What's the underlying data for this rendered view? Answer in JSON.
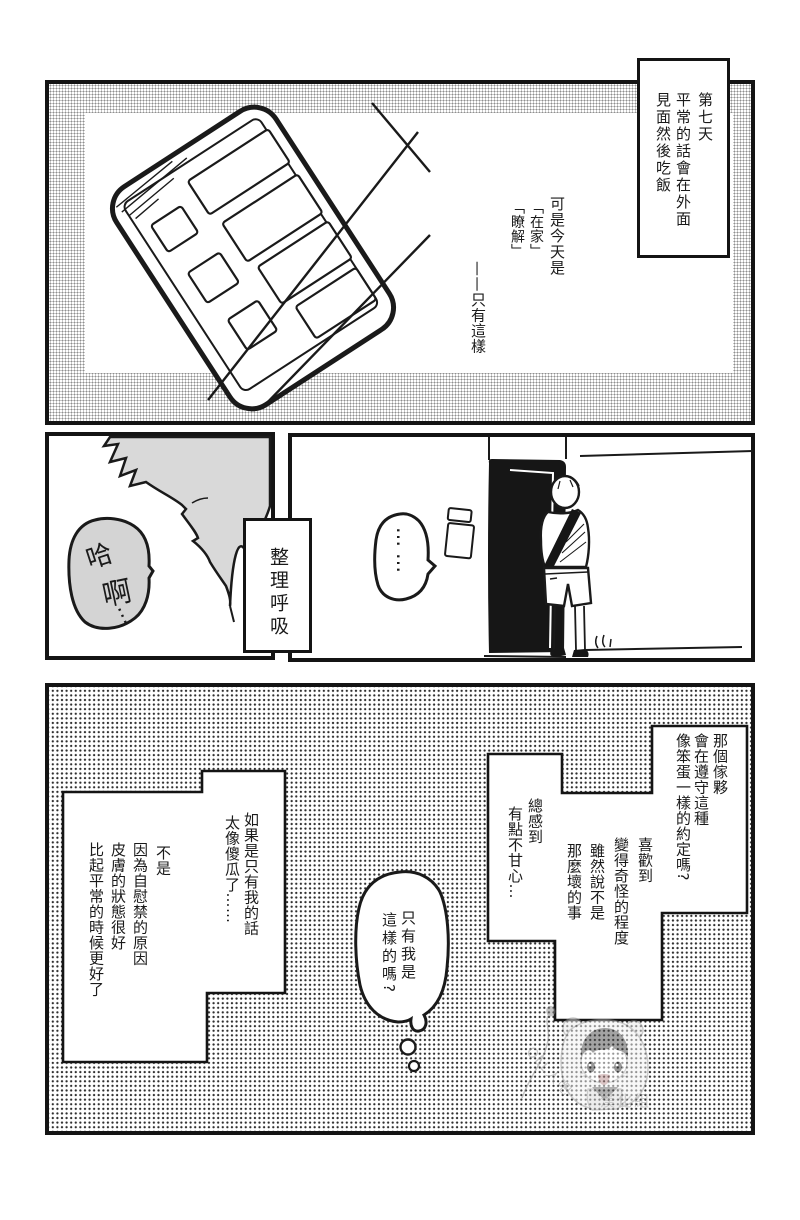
{
  "panel1": {
    "caption_days": {
      "cols": [
        "第七天",
        "平常的話會在外面",
        "見面然後吃飯"
      ]
    },
    "caption_today": {
      "cols": [
        "可是今天是",
        "「在家」",
        "「瞭解」",
        "——只有這樣"
      ]
    }
  },
  "panel2": {
    "breath": {
      "chars": [
        "哈",
        "啊",
        "…"
      ]
    },
    "caption_breath": "整理呼吸",
    "silence": "……"
  },
  "panel3": {
    "caption_promise": {
      "cols": [
        "那個傢夥",
        "會在遵守這種",
        "像笨蛋一樣的約定嗎?"
      ]
    },
    "caption_weird": {
      "cols": [
        "喜歡到",
        "變得奇怪的程度",
        "雖然說不是",
        "那麼壞的事"
      ]
    },
    "caption_bitter": {
      "cols": [
        "總感到",
        "有點不甘心…"
      ]
    },
    "caption_fool": {
      "cols": [
        "如果是只有我的話",
        "太像傻瓜了……"
      ]
    },
    "caption_skin": {
      "cols": [
        "不是",
        "因為自慰禁的原因",
        "皮膚的狀態很好",
        "比起平常的時候更好了"
      ]
    },
    "thought": {
      "cols": [
        "只有我是",
        "這樣的嗎?"
      ]
    }
  },
  "watermark": {
    "handle": "OLL人吧",
    "group": "漢化組"
  },
  "colors": {
    "ink": "#1a1a1a",
    "tone_gray": "#d9d9d9",
    "panel_border": "#141414"
  }
}
